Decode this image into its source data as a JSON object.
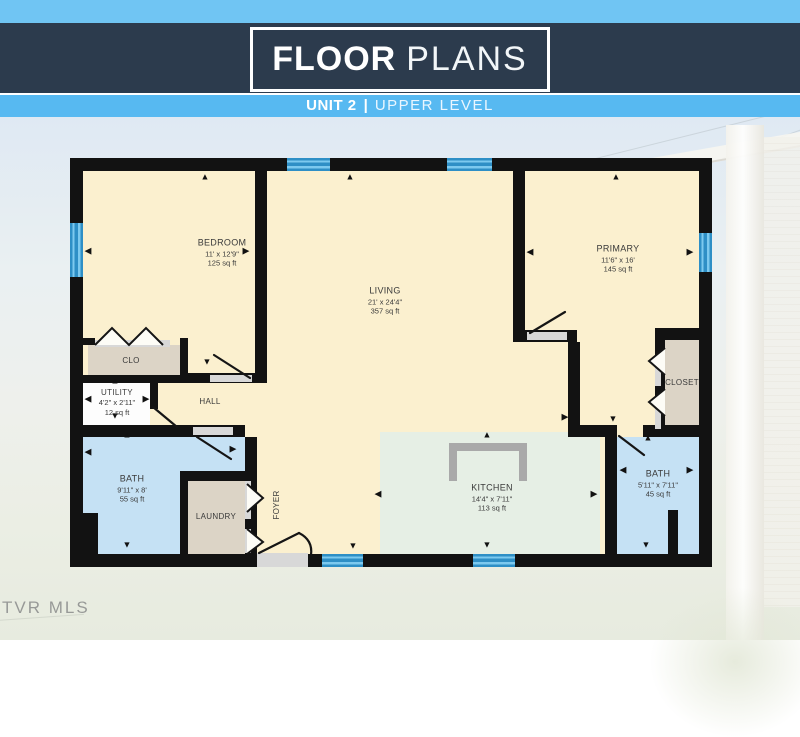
{
  "header": {
    "title_bold": "FLOOR",
    "title_light": "PLANS",
    "subtitle_unit": "UNIT 2",
    "subtitle_divider": "|",
    "subtitle_level": "UPPER LEVEL"
  },
  "watermark": "TVR MLS",
  "plan": {
    "rooms": [
      {
        "name": "BEDROOM",
        "dims": "11' x 12'9\"",
        "area": "125 sq ft"
      },
      {
        "name": "LIVING",
        "dims": "21' x 24'4\"",
        "area": "357 sq ft"
      },
      {
        "name": "PRIMARY",
        "dims": "11'6\" x 16'",
        "area": "145 sq ft"
      },
      {
        "name": "KITCHEN",
        "dims": "14'4\" x 7'11\"",
        "area": "113 sq ft"
      },
      {
        "name": "BATH",
        "dims": "9'11\" x 8'",
        "area": "55 sq ft"
      },
      {
        "name": "BATH",
        "dims": "5'11\" x 7'11\"",
        "area": "45 sq ft"
      },
      {
        "name": "UTILITY",
        "dims": "4'2\" x 2'11\"",
        "area": "12 sq ft"
      },
      {
        "name": "CLO"
      },
      {
        "name": "HALL"
      },
      {
        "name": "LAUNDRY"
      },
      {
        "name": "FOYER"
      },
      {
        "name": "CLOSET"
      }
    ]
  },
  "icons": {
    "up": "▲",
    "down": "▼",
    "left": "◀",
    "right": "▶"
  },
  "colors": {
    "banner_navy": "#2c3b4d",
    "ribbon_blue": "#57b9f1",
    "wall_black": "#121212",
    "room_cream": "#fbf0cf",
    "bath_blue": "#c5e1f4",
    "kitchen_green": "#e6efe5",
    "closet_tan": "#dcd4c6",
    "window_blue": "#2e8fc6"
  }
}
